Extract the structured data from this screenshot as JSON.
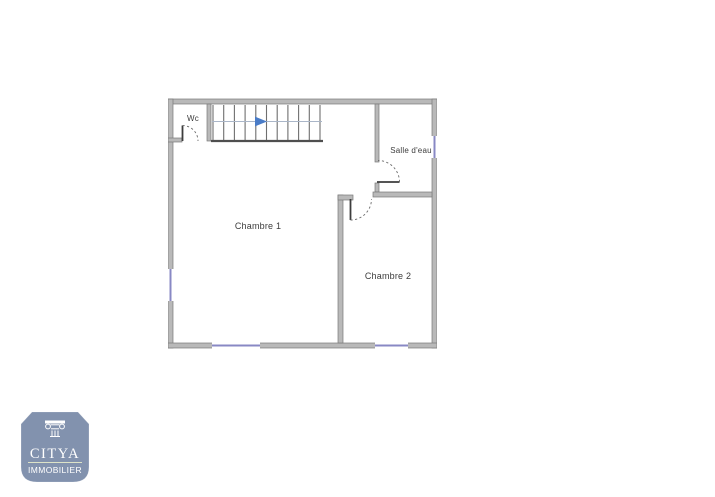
{
  "floor_plan": {
    "labels": {
      "wc": "Wc",
      "salle_deau": "Salle d'eau",
      "chambre_1": "Chambre 1",
      "chambre_2": "Chambre 2"
    },
    "stairs": {
      "icon": "stairs-direction-arrow-icon",
      "direction": "right"
    }
  },
  "logo": {
    "brand": "CITYA",
    "subtitle": "IMMOBILIER",
    "icon": "column-capital-icon"
  },
  "colors": {
    "page_background": "#ffffff",
    "wall_fill": "#b9b9b9",
    "wall_edge": "#7a7a7a",
    "window_line": "#8888c4",
    "stair_tread": "#6f6f6f",
    "stair_guide": "#aab6c8",
    "stair_arrow": "#4a7cc7",
    "door_line": "#3d3d3d",
    "door_arc": "#6a6a6a",
    "room_label": "#3c3c3c",
    "logo_badge": "#8292ae",
    "logo_text": "#ffffff",
    "logo_divider": "#dde3c8"
  }
}
